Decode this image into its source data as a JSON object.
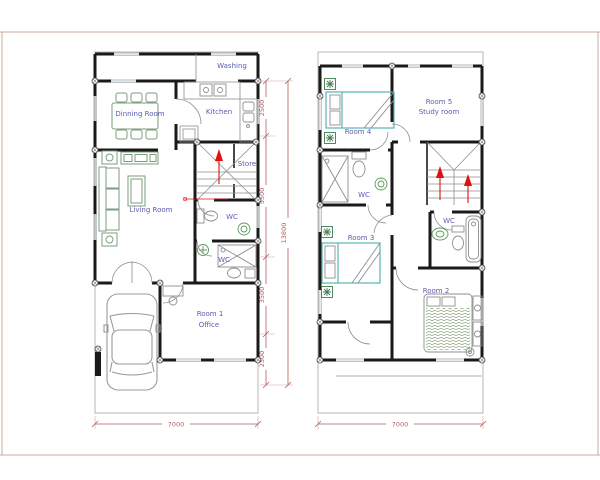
{
  "colors": {
    "wall": "#1a1a1a",
    "boundary": "#b0b0b0",
    "label": "#5d5dae",
    "dim": "#b25f5f",
    "ext": "#c7a89b",
    "furniture": "#7e9e7e",
    "plant": "#3f7d4f",
    "bed": "#58b3b3",
    "arrow": "#e01010",
    "border": "#cdab9c",
    "hatch": "#86a478"
  },
  "ground_floor": {
    "rooms": {
      "washing": "Washing",
      "dinning_room": "Dinning Room",
      "kitchen": "Kitchen",
      "store": "Store",
      "living_room": "Living Room",
      "wc_upper": "WC",
      "wc_lower": "WC",
      "room1_line1": "Room 1",
      "room1_line2": "Office"
    },
    "dimensions": {
      "top_section": "2500",
      "mid_section": "5500",
      "lower_section": "3500",
      "front_section": "2300",
      "total_depth": "13800",
      "width": "7000"
    }
  },
  "upper_floor": {
    "rooms": {
      "room4": "Room 4",
      "room5_line1": "Room 5",
      "room5_line2": "Study room",
      "wc_left": "WC",
      "room3": "Room 3",
      "wc_right": "WC",
      "room2": "Room 2"
    },
    "dimensions": {
      "width": "7000"
    }
  }
}
